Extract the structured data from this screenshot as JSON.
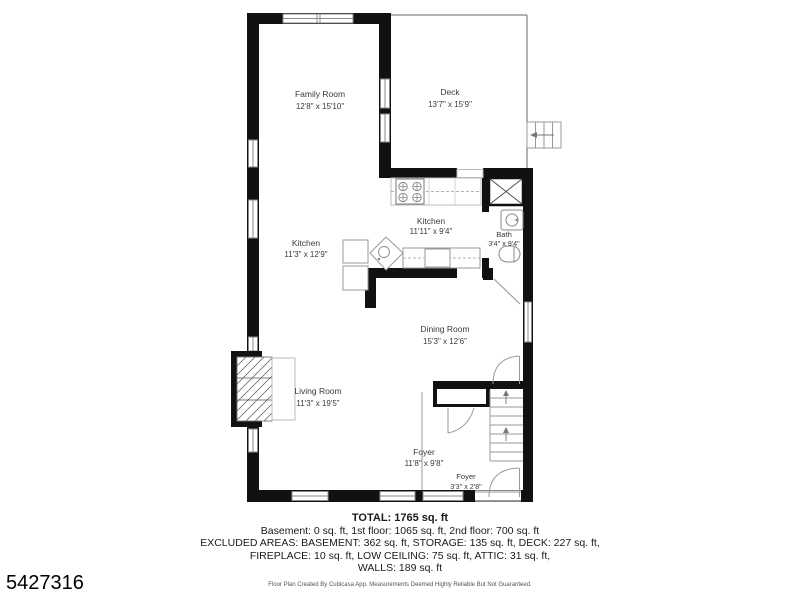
{
  "plan_id": "5427316",
  "rooms": {
    "family_room": {
      "name": "Family Room",
      "dims": "12'8\" x 15'10\""
    },
    "deck": {
      "name": "Deck",
      "dims": "13'7\" x 15'9\""
    },
    "kitchen_left": {
      "name": "Kitchen",
      "dims": "11'3\" x 12'9\""
    },
    "kitchen_right": {
      "name": "Kitchen",
      "dims": "11'11\" x 9'4\""
    },
    "bath": {
      "name": "Bath",
      "dims": "3'4\" x 9'4\""
    },
    "dining_room": {
      "name": "Dining Room",
      "dims": "15'3\" x 12'6\""
    },
    "living_room": {
      "name": "Living Room",
      "dims": "11'3\" x 19'5\""
    },
    "foyer_main": {
      "name": "Foyer",
      "dims": "11'8\" x 9'8\""
    },
    "foyer_entry": {
      "name": "Foyer",
      "dims": "3'3\" x 2'8\""
    }
  },
  "summary": {
    "total": "TOTAL: 1765 sq. ft",
    "floors": "Basement: 0 sq. ft, 1st floor: 1065 sq. ft, 2nd floor: 700 sq. ft",
    "excluded1": "EXCLUDED AREAS: BASEMENT: 362 sq. ft, STORAGE: 135 sq. ft, DECK: 227 sq. ft,",
    "excluded2": "FIREPLACE: 10 sq. ft, LOW CEILING: 75 sq. ft, ATTIC: 31 sq. ft,",
    "excluded3": "WALLS: 189 sq. ft"
  },
  "footer": {
    "disclaimer": "Floor Plan Created By Cubicasa App. Measurements Deemed Highly Reliable But Not Guaranteed."
  },
  "plan_features": [
    "stove",
    "kitchen-island-sink",
    "bath-sink",
    "toilet",
    "staircase",
    "deck-stairs",
    "fireplace",
    "storage-closet",
    "windows",
    "doors"
  ],
  "colors": {
    "wall": "#111111",
    "thin_line": "#999999",
    "label_text": "#3a3a3a"
  }
}
